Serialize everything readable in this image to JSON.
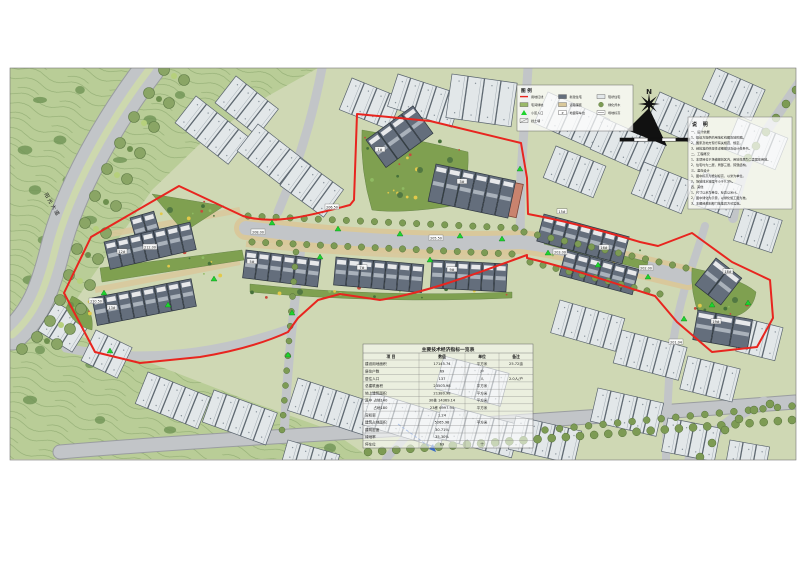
{
  "map": {
    "compass_label": "N",
    "road_labels": {
      "boulevard": "阳光大道"
    },
    "legend": {
      "title": "图 例",
      "items": [
        {
          "symbol": "red-line-swatch",
          "label": "用地红线"
        },
        {
          "symbol": "new-house-swatch",
          "label": "新建住宅"
        },
        {
          "symbol": "existing-house-swatch",
          "label": "现状住宅"
        },
        {
          "symbol": "green-swatch",
          "label": "宅间绿地"
        },
        {
          "symbol": "paving-swatch",
          "label": "道路铺装"
        },
        {
          "symbol": "tree-swatch",
          "label": "绿化乔木"
        },
        {
          "symbol": "entrance-swatch",
          "label": "小区入口"
        },
        {
          "symbol": "parking-swatch",
          "label": "地面停车位"
        },
        {
          "symbol": "elevation-swatch",
          "label": "场地标高"
        },
        {
          "symbol": "retaining-swatch",
          "label": "挡土墙"
        }
      ]
    },
    "notes": {
      "title": "说 明",
      "lines": [
        "一、设计依据",
        "1、建设方提供的用地红线图及地形图。",
        "2、国家及地方现行有关规范、规定。",
        "3、经批准的修建性详细规划及设计任务书。",
        "二、工程概况",
        "1、本项目位于场镇规划区内，用地性质为二类居住用地。",
        "2、住宅均为二层，局部三层，砖混结构。",
        "三、竖向设计",
        "1、图中标高为绝对标高，以米为单位。",
        "2、场地排水坡度不小于0.3%。",
        "四、其他",
        "1、尺寸以米为单位，标高以米计。",
        "2、图中绿化为示意，以绿化施工图为准。",
        "3、本图经规划部门批准后方可实施。"
      ]
    },
    "table": {
      "title": "主要技术经济指标一览表",
      "header": [
        "项  目",
        "数值",
        "单位",
        "备注"
      ],
      "rows": [
        [
          "建设用地面积",
          "17145.74",
          "平方米",
          "25.72亩"
        ],
        [
          "居住户数",
          "69",
          "户",
          ""
        ],
        [
          "居住人口",
          "137",
          "人",
          "2.0人/户"
        ],
        [
          "总建筑面积",
          "23503.98",
          "平方米",
          ""
        ],
        [
          "地上建筑面积",
          "21380.98",
          "平方米",
          ""
        ],
        [
          "其中 占地140",
          "30栋 14369.14",
          "平方米",
          ""
        ],
        [
          "　　 占地180",
          "23栋 6997.94",
          "平方米",
          ""
        ],
        [
          "容积率",
          "1.24",
          "",
          ""
        ],
        [
          "建筑占地面积",
          "5265.98",
          "平方米",
          ""
        ],
        [
          "建筑密度",
          "30.71%",
          "",
          ""
        ],
        [
          "绿地率",
          "35.30%",
          "",
          ""
        ],
        [
          "停车位",
          "69",
          "个",
          ""
        ]
      ]
    },
    "spot_elevations": [
      "212.00",
      "210.50",
      "208.00",
      "206.50",
      "205.50",
      "203.00",
      "202.00",
      "201.04"
    ],
    "building_labels": [
      "1#",
      "3#",
      "5#",
      "7#",
      "9#",
      "12#",
      "13#",
      "15#",
      "16#",
      "18#",
      "19#"
    ],
    "colors": {
      "boundary_red": "#e8251f",
      "site_building": "#646e7c",
      "existing_building": "#e2e7e9",
      "road": "#c2c5c8",
      "sidewalk_tan": "#d9c89b",
      "greenfield": "#cfd8b4",
      "hill": "#b9cd97",
      "garden": "#7fa050",
      "tree": "#7d9b54",
      "entrance_marker": "#1fd32f"
    }
  }
}
